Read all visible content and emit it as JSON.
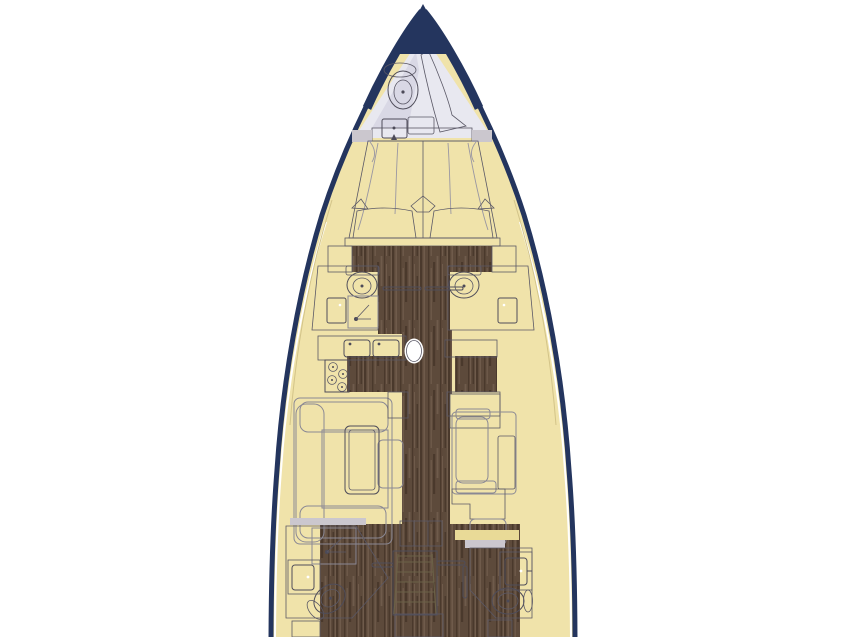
{
  "diagram": {
    "type": "yacht-deck-plan",
    "areas": [
      "bow-tip",
      "forepeak-head",
      "owner-cabin",
      "port-mid-head",
      "starboard-mid-head",
      "galley",
      "mast",
      "chart-area",
      "salon-port",
      "salon-starboard",
      "aft-port-head",
      "aft-starboard-head",
      "companionway-stairs"
    ],
    "fixtures": [
      "toilet",
      "sink",
      "shower-drain",
      "stove-burners",
      "double-sink",
      "bed-pillows",
      "saloon-table",
      "stairs",
      "door-leaf"
    ]
  },
  "colors": {
    "page_bg": "#ffffff",
    "hull_navy": "#24355e",
    "deck_yellow": "#f0e3aa",
    "wall_yellow": "#e9da97",
    "table_yellow": "#ecdf9e",
    "stairs_cream": "#f4ecc6",
    "wood_base": "#5d4a3b",
    "wood_streak_dark": "#4a392c",
    "wood_streak_light": "#6f5b4b",
    "furniture_gray": "#cbc7ce",
    "furniture_gray_dark": "#8f8e9b",
    "cushion_inner": "#d9d5d4",
    "sofa_base": "#f1f0f3",
    "fixture_white": "#ffffff",
    "bath_floor": "#fbfbfd",
    "forepeak_floor": "#e8e8f0",
    "forepeak_shadow": "#d9d8e5",
    "bench_dot_bg": "#d7d5db",
    "outline": "#4c4a58",
    "gap_white": "#ffffff"
  }
}
